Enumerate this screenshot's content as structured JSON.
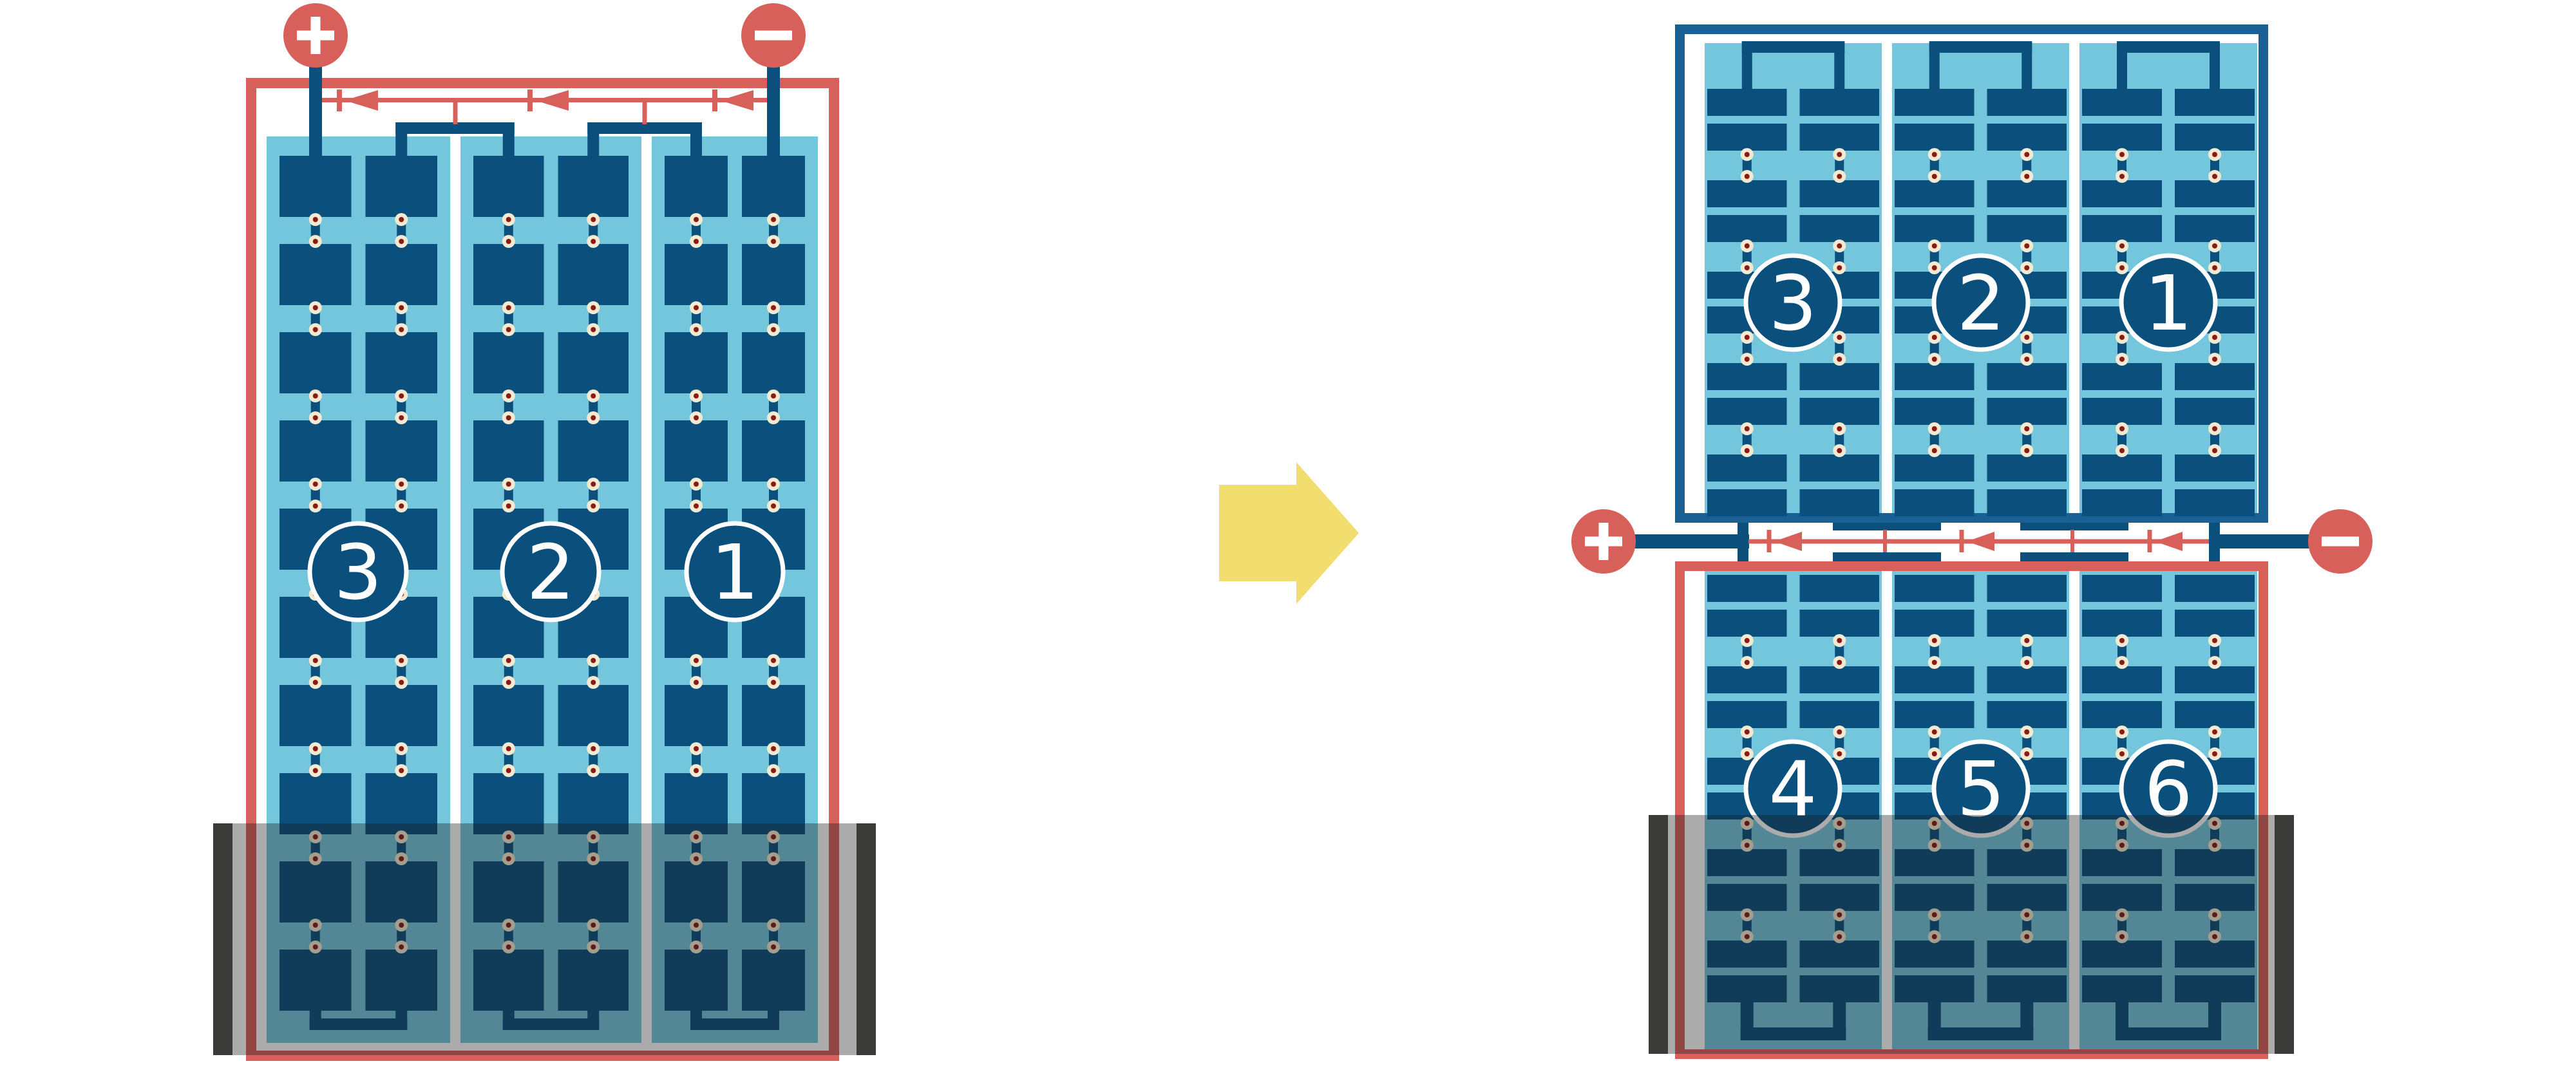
{
  "diagram": {
    "left_panel": {
      "name": "full-cell solar panel with bottom shading",
      "strings": [
        {
          "label": "3"
        },
        {
          "label": "2"
        },
        {
          "label": "1"
        }
      ],
      "terminals": {
        "positive": "+",
        "negative": "−"
      }
    },
    "right_panel": {
      "name": "half-cut cell solar panel with bottom shading",
      "top_strings": [
        {
          "label": "3"
        },
        {
          "label": "2"
        },
        {
          "label": "1"
        }
      ],
      "bottom_strings": [
        {
          "label": "4"
        },
        {
          "label": "5"
        },
        {
          "label": "6"
        }
      ],
      "terminals": {
        "positive": "+",
        "negative": "−"
      }
    },
    "icons": {
      "arrow": "right-block-arrow",
      "diode": "left-pointing-bypass-diode",
      "solder": "solder-point"
    },
    "colors": {
      "red": "#D7605B",
      "frame_blue": "#1A6094",
      "cell_blue": "#0B4F7D",
      "panel_blue": "#74C6DD",
      "solder_cream": "#F4EAD1",
      "solder_dot": "#8B1A15",
      "arrow_yellow": "#F2DE6E",
      "shade_bar": "#3A3A38",
      "shade_overlay": "rgba(28,28,28,0.37)",
      "white": "#FFFFFF"
    }
  }
}
